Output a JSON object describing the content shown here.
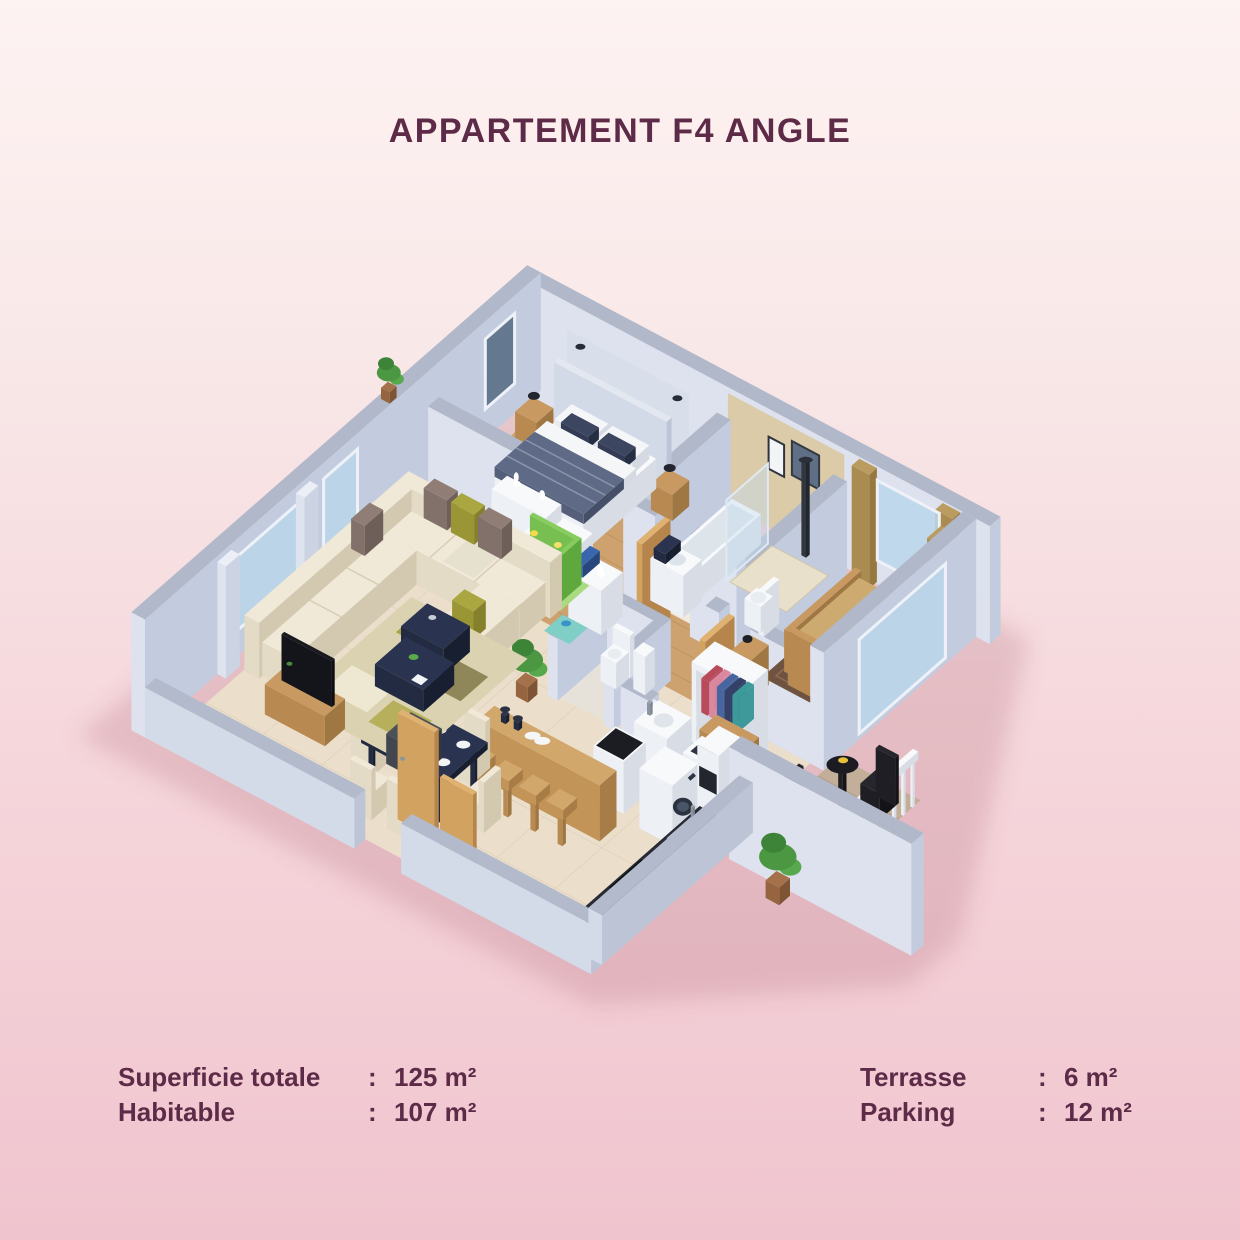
{
  "title": "APPARTEMENT F4 ANGLE",
  "stats": {
    "separator": ":",
    "left": [
      {
        "label": "Superficie totale",
        "value": "125 m²"
      },
      {
        "label": "Habitable",
        "value": "107 m²"
      }
    ],
    "right": [
      {
        "label": "Terrasse",
        "value": "6 m²"
      },
      {
        "label": "Parking",
        "value": "12 m²"
      }
    ]
  },
  "theme": {
    "text_color": "#5d2b47",
    "background_top": "#fdf3f2",
    "background_bottom": "#f0c4ce",
    "wall_color": "#c3cbde",
    "wood_floor_color": "#cda26f",
    "tile_floor_color": "#ebdfcc"
  }
}
